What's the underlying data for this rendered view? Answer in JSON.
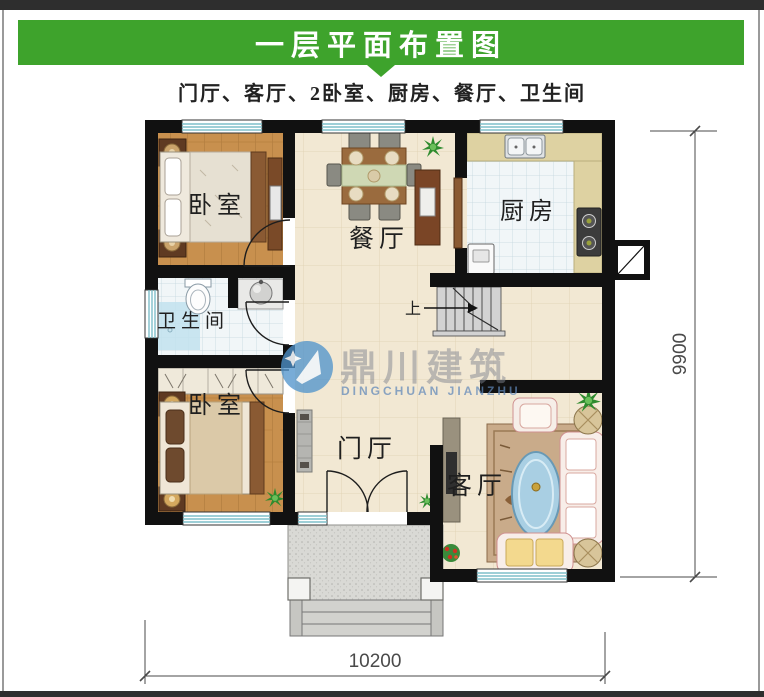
{
  "page": {
    "banner_title": "一层平面布置图",
    "subtitle": "门厅、客厅、2卧室、厨房、餐厅、卫生间"
  },
  "floor_plan": {
    "rooms": {
      "bedroom_top": "卧室",
      "dining": "餐厅",
      "kitchen": "厨房",
      "bathroom": "卫生间",
      "bedroom_bottom": "卧室",
      "foyer": "门厅",
      "living": "客厅"
    },
    "stairs_up": "上",
    "dim_width": "10200",
    "dim_height": "9900"
  },
  "watermark": {
    "name_cn": "鼎川建筑",
    "name_en": "DINGCHUAN JIANZHU"
  },
  "colors": {
    "banner_green": "#3ea32c",
    "wall_black": "#111111",
    "wood_floor": "#c8904e",
    "cream_floor": "#f2e8d3",
    "tile_white": "#f1f6f8",
    "window_teal": "#7fbfca",
    "shower_blue": "#c2e2ef",
    "stair_gray": "#d2d2d2",
    "porch_gray": "#d9d9d5",
    "counter_khaki": "#ded2a2",
    "watermark_blue": "#4f93cb"
  }
}
